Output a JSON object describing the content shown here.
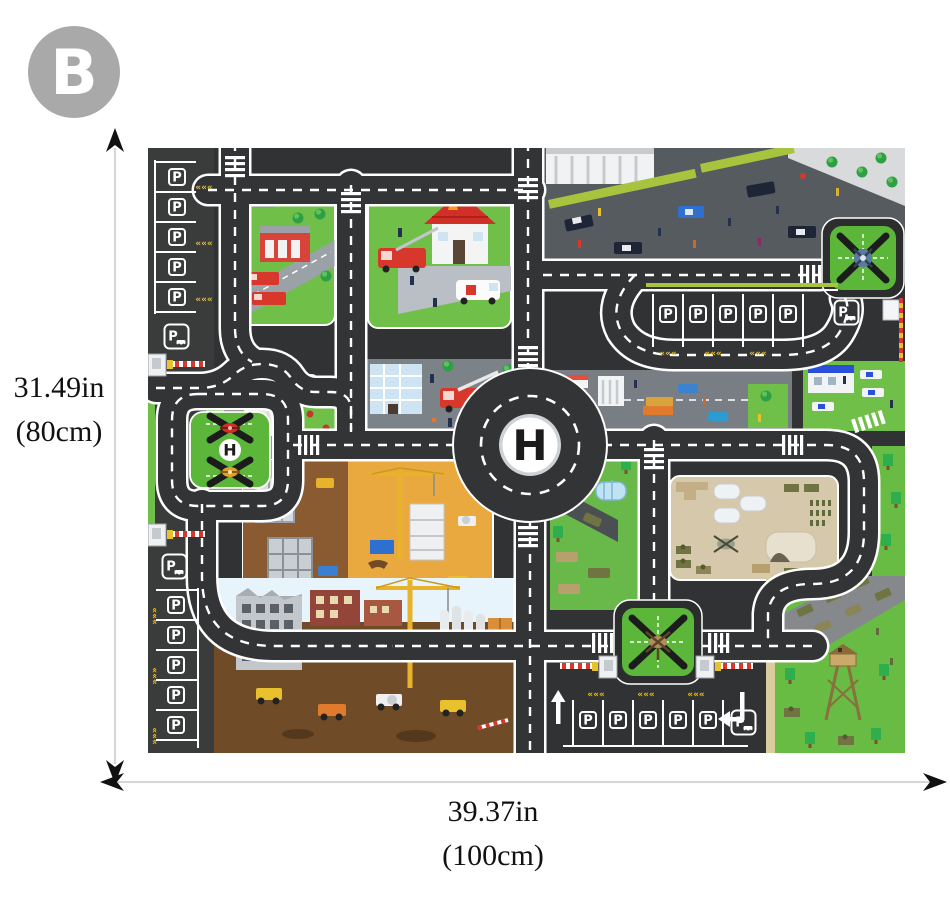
{
  "badge": {
    "label": "B"
  },
  "dimensions": {
    "height": {
      "inches": "31.49in",
      "cm": "(80cm)"
    },
    "width": {
      "inches": "39.37in",
      "cm": "(100cm)"
    }
  },
  "mat": {
    "labels": {
      "parking": "P",
      "helipad": "H",
      "chevron_mark": "«««"
    },
    "colors": {
      "road": "#333435",
      "road_line": "#ffffff",
      "parking_asphalt": "#3a3b3b",
      "grass": "#6fbf49",
      "pad_green": "#5cb63a",
      "chevron_yellow": "#e8c12c",
      "fire_red": "#d8372b",
      "construction_orange": "#e9a93f",
      "military_tan": "#d6c9ab",
      "police_asphalt": "#565b60",
      "badge_gray": "#a9a9a9"
    }
  }
}
